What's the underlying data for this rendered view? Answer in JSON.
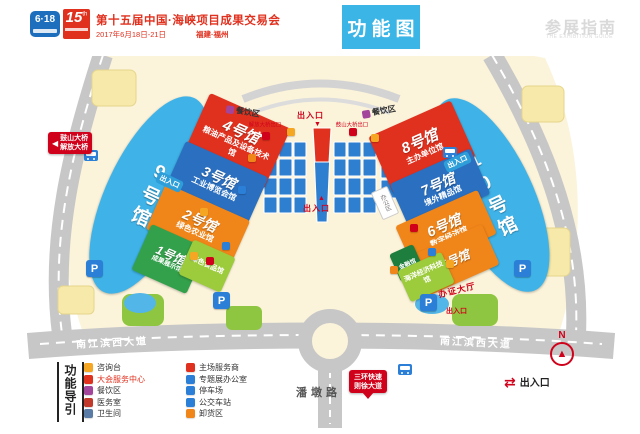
{
  "colors": {
    "red": "#e0301e",
    "blue": "#2a6fc0",
    "orange": "#f08519",
    "green": "#33a14b",
    "light_green": "#9ccb3b",
    "sky_blue": "#3fb3e8",
    "cyan": "#3ab5e6"
  },
  "header": {
    "logo_618": "6·18",
    "logo_15": "15",
    "logo_15_sup": "th",
    "title": "第十五届中国·海峡项目成果交易会",
    "date": "2017年6月18日-21日",
    "location": "福建·福州",
    "tag": "功能图",
    "guide_cn": "参展指南",
    "guide_en": "THE EXHIBITION GUIDE"
  },
  "halls": {
    "h1": {
      "name": "1号馆",
      "sub": "成果展示馆"
    },
    "h1b": {
      "name": "绿色食品馆"
    },
    "h2": {
      "name": "2号馆",
      "sub": "绿色农业馆"
    },
    "h3": {
      "name": "3号馆",
      "sub": "工业博览会馆"
    },
    "h4": {
      "name": "4号馆",
      "sub": "粮油产品及设备技术馆"
    },
    "h5": {
      "name": "5号馆"
    },
    "h5b": {
      "name": "海洋经济科技馆"
    },
    "h5c": {
      "name": "金融馆"
    },
    "h6": {
      "name": "6号馆",
      "sub": "数字经济馆"
    },
    "h7": {
      "name": "7号馆",
      "sub": "境外精品馆"
    },
    "h8": {
      "name": "8号馆",
      "sub": "主办单位馆"
    },
    "h9": {
      "name": "9号馆"
    },
    "h10": {
      "name": "10号馆"
    }
  },
  "map_labels": {
    "dining_left": "餐饮区",
    "dining_right": "餐饮区",
    "entrance_top": "出入口",
    "entrance_bottom": "出入口",
    "exit_pill_left": "出入口",
    "exit_pill_right": "出入口",
    "exit_note_left": "解放大桥出口",
    "exit_note_right": "鼓山大桥出口",
    "office": "办公区",
    "cert_hall": "办证大厅",
    "cert_exit": "出入口",
    "bridge_sign_arrow": "◀",
    "bridge_sign_1": "鼓山大桥",
    "bridge_sign_2": "解放大桥",
    "expressway_sign_1": "三环快速",
    "expressway_sign_2": "则徐大道",
    "road_left": "南江滨西大道",
    "road_right": "南江滨西大道",
    "road_bottom": "潘墩路",
    "parking": "P",
    "compass_n": "N",
    "compass_needle": "▲",
    "exit_arrows": "⇄",
    "exit_legend": "出入口",
    "arrow_up": "▲",
    "arrow_down": "▼"
  },
  "legend": {
    "title": "功能导引",
    "col1": [
      {
        "label": "咨询台"
      },
      {
        "label": "大会服务中心"
      },
      {
        "label": "餐饮区"
      },
      {
        "label": "医务室"
      },
      {
        "label": "卫生间"
      }
    ],
    "col2": [
      {
        "label": "主场服务商"
      },
      {
        "label": "专题展办公室"
      },
      {
        "label": "停车场"
      },
      {
        "label": "公交车站"
      },
      {
        "label": "卸货区"
      }
    ]
  }
}
